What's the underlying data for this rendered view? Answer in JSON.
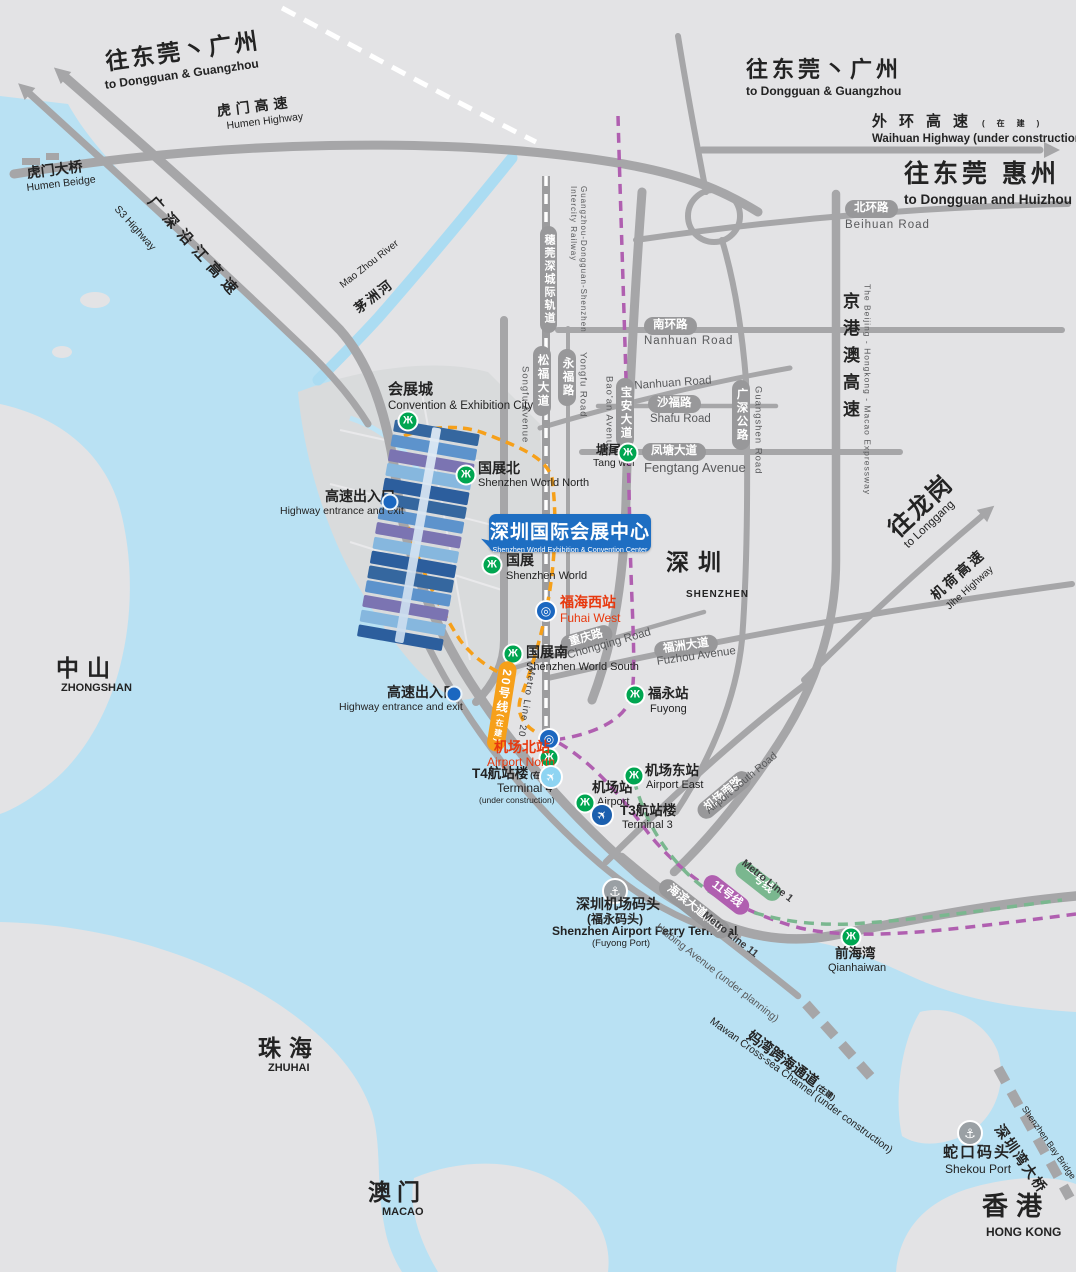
{
  "colors": {
    "water": "#b9e1f3",
    "land": "#e3e3e5",
    "reclaimed": "#d9dbdc",
    "road": "#a6a6a8",
    "pill_gray": "#98989a",
    "metro_green": "#00a651",
    "line20_orange": "#f6a01a",
    "line11_purple": "#b05fb0",
    "line1_green": "#7ab78f",
    "venue_blue": "#1e6ec2",
    "station_red": "#e8380d",
    "rail_blue": "#1b67c0",
    "t4_lightblue": "#8ed4f2",
    "t3_blue": "#1b5fae"
  },
  "icons": {
    "metro": "Ж",
    "rail": "◎",
    "plane": "✈",
    "anchor": "⚓"
  },
  "labels": {
    "dir_nw": {
      "zh": "往东莞丶广州",
      "en": "to Dongguan & Guangzhou"
    },
    "dir_ne": {
      "zh": "往东莞丶广州",
      "en": "to Dongguan & Guangzhou"
    },
    "dir_east": {
      "zh": "往东莞 惠州",
      "en": "to Dongguan and Huizhou"
    },
    "dir_longgang": {
      "zh": "往龙岗",
      "en": "to Longgang"
    }
  },
  "regions": {
    "zhongshan": {
      "zh": "中山",
      "en": "ZHONGSHAN"
    },
    "shenzhen": {
      "zh": "深圳",
      "en": "SHENZHEN"
    },
    "zhuhai": {
      "zh": "珠海",
      "en": "ZHUHAI"
    },
    "macao": {
      "zh": "澳门",
      "en": "MACAO"
    },
    "hongkong": {
      "zh": "香港",
      "en": "HONG KONG"
    }
  },
  "highways": {
    "humen": {
      "zh": "虎门高速",
      "en": "Humen Highway"
    },
    "s3": {
      "en": "S3 Highway"
    },
    "yanjiang": {
      "zh": "广深沿江高速"
    },
    "waihuan": {
      "zh": "外环高速",
      "note": "(在建)",
      "en": "Waihuan Highway (under construction)"
    },
    "jinggangao": {
      "zh": "京港澳高速",
      "en": "The Beijing - Hongkong - Macao Expressway"
    },
    "jihe": {
      "zh": "机荷高速",
      "en": "Jihe Highway"
    }
  },
  "bridges": {
    "humen": {
      "zh": "虎门大桥",
      "en": "Humen Beidge"
    },
    "bay": {
      "zh": "深圳湾大桥",
      "en": "Shenzhen Bay Bridge"
    },
    "mawan": {
      "zh": "妈湾跨海通道",
      "note": "(在建)",
      "en": "Mawan Cross-sea Channel (under construction)"
    }
  },
  "river": {
    "zh": "茅洲河",
    "en": "Mao Zhou River"
  },
  "roads": {
    "beihuan": {
      "zh": "北环路",
      "en": "Beihuan Road"
    },
    "nanhuan": {
      "zh": "南环路",
      "en": "Nanhuan Road"
    },
    "shafu": {
      "zh": "沙福路",
      "en": "Shafu Road"
    },
    "fengtang": {
      "zh": "凤塘大道",
      "en": "Fengtang Avenue"
    },
    "songfu": {
      "zh": "松福大道",
      "en": "Songfu Avenue"
    },
    "yongfu": {
      "zh": "永福路",
      "en": "Yongfu Road"
    },
    "baoan": {
      "zh": "宝安大道",
      "en": "Bao'an Avenue"
    },
    "guangshen": {
      "zh": "广深公路",
      "en": "Guangshen Road"
    },
    "chongqing": {
      "zh": "重庆路",
      "en": "Chongqing Road"
    },
    "fuzhou": {
      "zh": "福洲大道",
      "en": "Fuzhou Avenue"
    },
    "airport_south": {
      "zh": "机场南路",
      "en": "Airport South Road"
    },
    "haibing": {
      "zh": "海滨大道",
      "note": "(规划)",
      "en": "Haibing Avenue (under planning)"
    }
  },
  "rail": {
    "intercity": {
      "zh": "穗莞深城际轨道",
      "en": "Guangzhou-Dongguan-Shenzhen Intercity Railway"
    }
  },
  "metro": {
    "line20": {
      "zh": "20号线",
      "note": "(在建)",
      "en": "Metro Line 20"
    },
    "line11": {
      "zh": "11号线",
      "en": "Metro Line 11"
    },
    "line1": {
      "zh": "一号线",
      "en": "Metro Line 1"
    }
  },
  "stations": {
    "cec_city": {
      "zh": "会展城",
      "en": "Convention & Exhibition City"
    },
    "world_north": {
      "zh": "国展北",
      "en": "Shenzhen World North"
    },
    "world": {
      "zh": "国展",
      "en": "Shenzhen World"
    },
    "world_south": {
      "zh": "国展南",
      "en": "Shenzhen World South"
    },
    "tangwei": {
      "zh": "塘尾",
      "en": "Tang wei"
    },
    "fuhai_west": {
      "zh": "福海西站",
      "en": "Fuhai West"
    },
    "fuyong": {
      "zh": "福永站",
      "en": "Fuyong"
    },
    "airport_north": {
      "zh": "机场北站",
      "en": "Airport North"
    },
    "airport": {
      "zh": "机场站",
      "en": "Airport"
    },
    "airport_east": {
      "zh": "机场东站",
      "en": "Airport East"
    },
    "qianhaiwan": {
      "zh": "前海湾",
      "en": "Qianhaiwan"
    }
  },
  "terminals": {
    "t4": {
      "zh": "T4航站楼",
      "note": "(在建)",
      "en": "Terminal 4",
      "sub": "(under construction)"
    },
    "t3": {
      "zh": "T3航站楼",
      "en": "Terminal 3"
    }
  },
  "venue": {
    "zh": "深圳国际会展中心",
    "en": "Shenzhen World Exhibition & Convention Center"
  },
  "poi": {
    "hw_exit": {
      "zh": "高速出入口",
      "en": "Highway entrance and exit"
    },
    "ferry": {
      "zh": "深圳机场码头",
      "zh2": "(福永码头)",
      "en": "Shenzhen Airport Ferry Terminal",
      "en2": "(Fuyong Port)"
    },
    "shekou": {
      "zh": "蛇口码头",
      "en": "Shekou Port"
    }
  }
}
